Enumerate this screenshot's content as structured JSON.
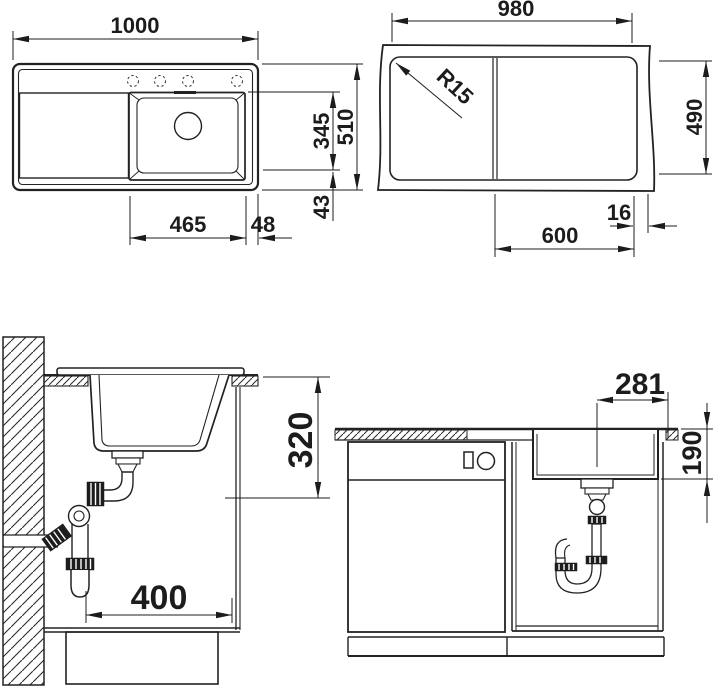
{
  "page": {
    "background": "#ffffff",
    "line_color": "#222222"
  },
  "views": {
    "plan": {
      "dims": {
        "overall_width": "1000",
        "overall_depth": "510",
        "bowl_depth": "345",
        "bowl_to_front": "43",
        "bowl_width": "465",
        "bowl_to_right": "48"
      }
    },
    "cutout": {
      "dims": {
        "cutout_width": "980",
        "cutout_depth": "490",
        "corner_radius": "R15",
        "edge_offset": "16",
        "bowl_cutout_width": "600"
      }
    },
    "section_side": {
      "dims": {
        "depth_below_counter": "320",
        "trap_clearance": "400"
      }
    },
    "section_front": {
      "dims": {
        "drain_offset": "281",
        "bowl_height": "190"
      }
    }
  }
}
